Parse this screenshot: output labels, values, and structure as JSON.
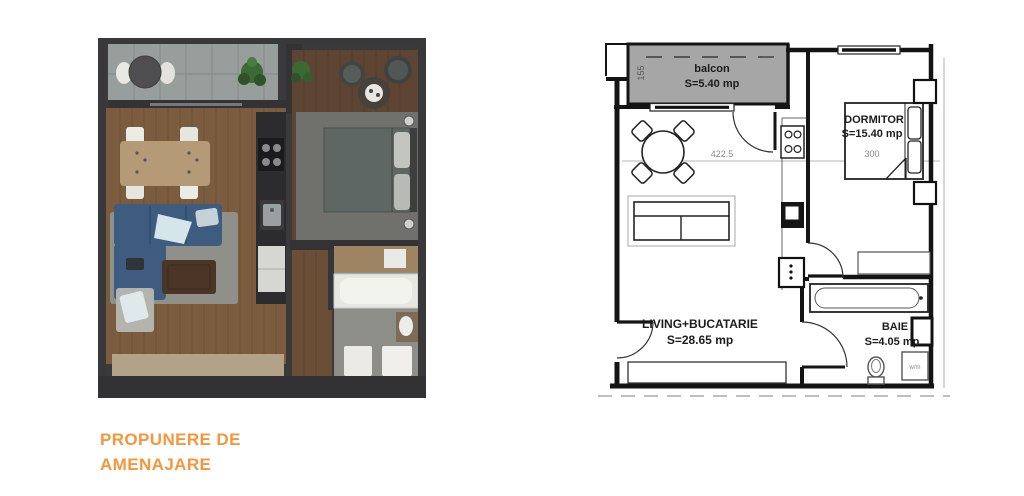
{
  "caption": {
    "line1": "PROPUNERE DE",
    "line2": "AMENAJARE"
  },
  "colors": {
    "accent_orange": "#F7953B",
    "wall_dark": "#3a3a3c",
    "wood_living": "#7c5c3e",
    "wood_bedroom": "#5e4533",
    "balcony_gray": "#989e9c",
    "sofa_blue": "#3e5b80",
    "plan_balcony_fill": "#a6a6a6"
  },
  "technical_plan": {
    "rooms": [
      {
        "name": "balcon",
        "area": "S=5.40 mp"
      },
      {
        "name": "DORMITOR",
        "area": "S=15.40 mp"
      },
      {
        "name": "LIVING+BUCATARIE",
        "area": "S=28.65 mp"
      },
      {
        "name": "BAIE",
        "area": "S=4.05 mp"
      }
    ],
    "dimensions": {
      "balcony_depth": "155",
      "living_width": "422.5",
      "bed_width": "300"
    },
    "labels": {
      "washing_machine": "w/m"
    }
  }
}
